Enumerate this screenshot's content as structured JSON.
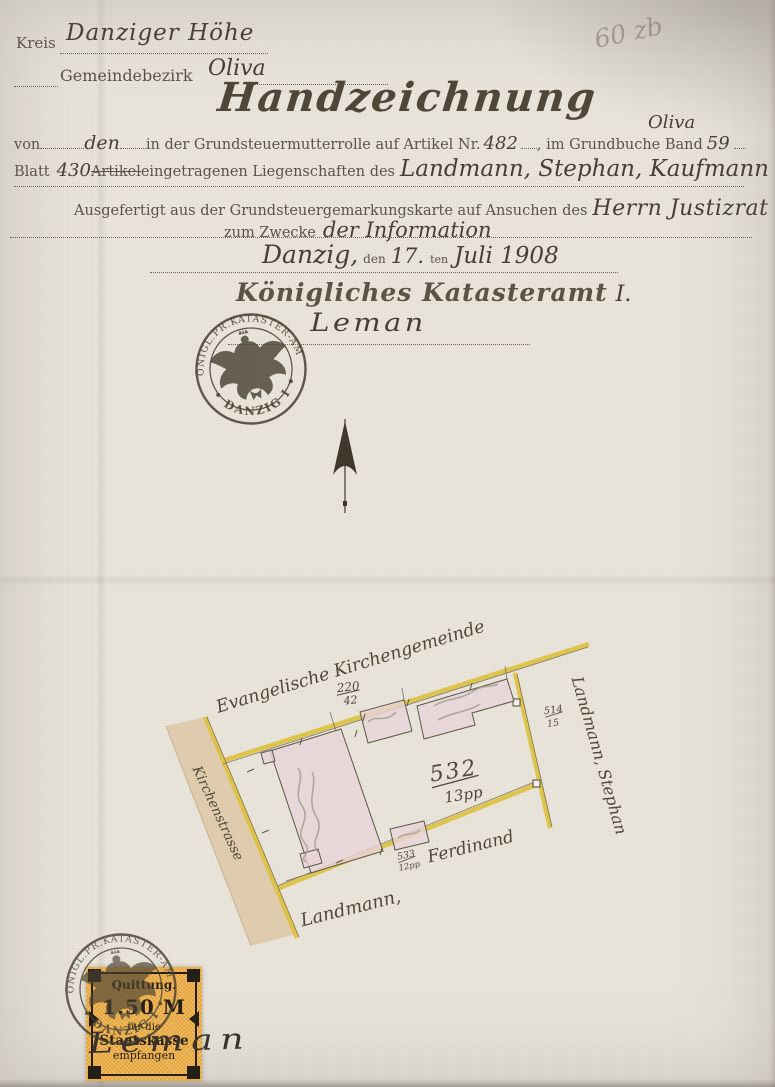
{
  "colors": {
    "paper": "#e9e5db",
    "printed_ink": "#5a5446",
    "handwritten_ink": "#463f33",
    "pencil": "#aaa499",
    "boundary_yellow": "#dec13d",
    "building_pink": "#e9d4d8",
    "street_tan": "#d7b381",
    "fee_stamp_orange": "#f1ba5c",
    "fee_stamp_black": "#241f17",
    "seal_ink": "#4a4334"
  },
  "annotations": {
    "pencil_note": "60 zb"
  },
  "header": {
    "kreis_label": "Kreis",
    "kreis_value": "Danziger Höhe",
    "bezirk_label": "Gemeindebezirk",
    "bezirk_value": "Oliva"
  },
  "title": "Handzeichnung",
  "form": {
    "von_label": "von",
    "von_value": "den",
    "mutterrolle_label": "in der Grundsteuermutterrolle auf Artikel Nr.",
    "artikel_nr": "482",
    "grundbuch_label": ", im Grundbuche Band",
    "band_nr": "59",
    "band_note": "Oliva",
    "blatt_label": "Blatt",
    "blatt_nr": "430",
    "artikel_label": "Artikel",
    "liegenschaften_label": "eingetragenen Liegenschaften des",
    "owner": "Landmann, Stephan, Kaufmann",
    "ausgefertigt_label": "Ausgefertigt aus der Grundsteuergemarkungskarte auf Ansuchen des",
    "requester": "Herrn Justizrat Lau",
    "zweck_label": "zum Zwecke",
    "zweck_value": "der Information",
    "city": "Danzig,",
    "den_label": "den",
    "day": "17.",
    "ten_label": "ten",
    "date": "Juli 1908"
  },
  "office": {
    "name": "Königliches Katasteramt",
    "suffix": "I.",
    "signature": "Leman"
  },
  "seal": {
    "arc_top": "KÖNIGL.PR.KATASTER-AMT",
    "arc_bottom": "• DANZIG I •"
  },
  "map": {
    "north_neighbor": "Evangelische Kirchengemeinde",
    "north_parcel": {
      "num": "220",
      "den": "42"
    },
    "parcel": {
      "num": "532",
      "den": "13pp"
    },
    "south_parcel": {
      "num": "533",
      "den": "12pp"
    },
    "east_parcel": {
      "num": "514",
      "den": "15"
    },
    "south_neighbor_line1": "Landmann,",
    "south_neighbor_line2": "Ferdinand",
    "east_neighbor": "Landmann, Stephan",
    "street": "Kirchenstrasse"
  },
  "fee_stamp": {
    "title": "Quittung.",
    "amount": "1.50 M",
    "line3": "für die",
    "line4": "Staatskasse",
    "line5": "empfangen",
    "signature": "Leman"
  }
}
